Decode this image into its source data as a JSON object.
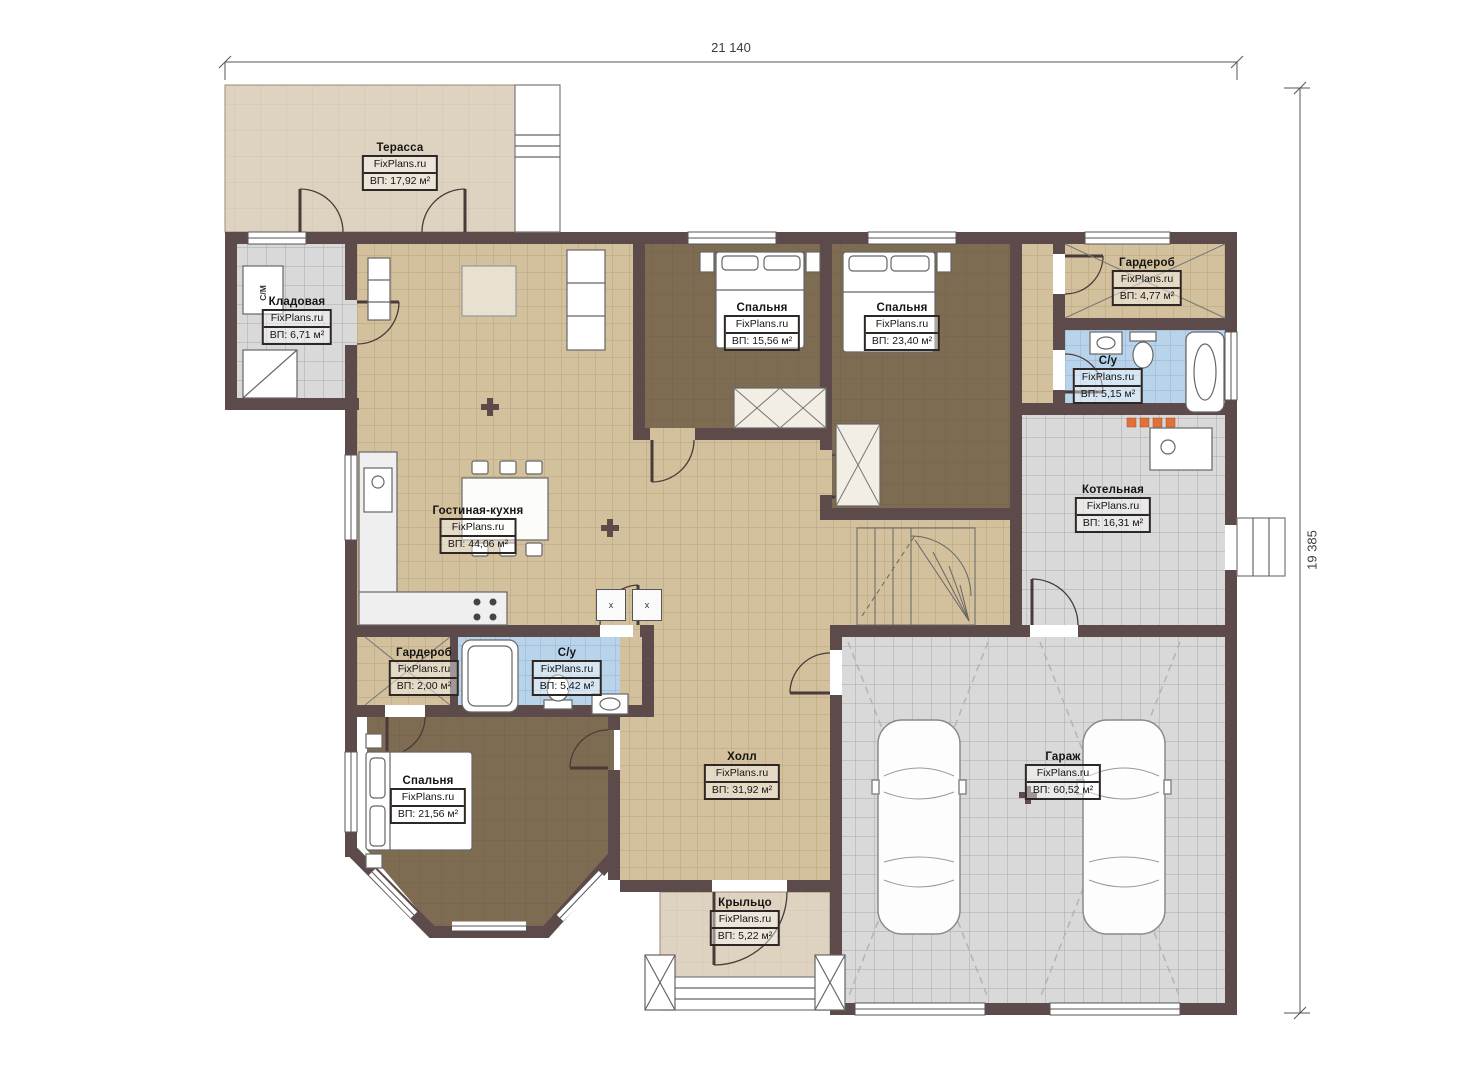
{
  "plan": {
    "type": "house-floor-plan",
    "brand_watermark": "FixPlans.ru"
  },
  "dimensions": {
    "width_label": "21 140",
    "height_label": "19 385"
  },
  "rooms": [
    {
      "name": "Терасса",
      "brand": "FixPlans.ru",
      "area": "ВП: 17,92 м²"
    },
    {
      "name": "Кладовая",
      "brand": "FixPlans.ru",
      "area": "ВП: 6,71 м²"
    },
    {
      "name": "Спальня",
      "brand": "FixPlans.ru",
      "area": "ВП: 15,56 м²"
    },
    {
      "name": "Спальня",
      "brand": "FixPlans.ru",
      "area": "ВП: 23,40 м²"
    },
    {
      "name": "Гардероб",
      "brand": "FixPlans.ru",
      "area": "ВП: 4,77 м²"
    },
    {
      "name": "С/у",
      "brand": "FixPlans.ru",
      "area": "ВП: 5,15 м²"
    },
    {
      "name": "Котельная",
      "brand": "FixPlans.ru",
      "area": "ВП: 16,31 м²"
    },
    {
      "name": "Гостиная-кухня",
      "brand": "FixPlans.ru",
      "area": "ВП: 44,06 м²"
    },
    {
      "name": "Гардероб",
      "brand": "FixPlans.ru",
      "area": "ВП: 2,00 м²"
    },
    {
      "name": "С/у",
      "brand": "FixPlans.ru",
      "area": "ВП: 5,42 м²"
    },
    {
      "name": "Спальня",
      "brand": "FixPlans.ru",
      "area": "ВП: 21,56 м²"
    },
    {
      "name": "Холл",
      "brand": "FixPlans.ru",
      "area": "ВП: 31,92 м²"
    },
    {
      "name": "Гараж",
      "brand": "FixPlans.ru",
      "area": "ВП: 60,52 м²"
    },
    {
      "name": "Крыльцо",
      "brand": "FixPlans.ru",
      "area": "ВП: 5,22 м²"
    }
  ],
  "markers": {
    "washing_machine": "С/М",
    "stools": [
      "x",
      "x"
    ]
  },
  "colors": {
    "wall": "#5d4b4c",
    "tile_beige": "#d3c09c",
    "tile_grey": "#d9d9d9",
    "tile_blue": "#b9d4ea",
    "floor_brown": "#7d6b52",
    "terrace": "#ded3c0",
    "accent_orange": "#e2703a"
  }
}
